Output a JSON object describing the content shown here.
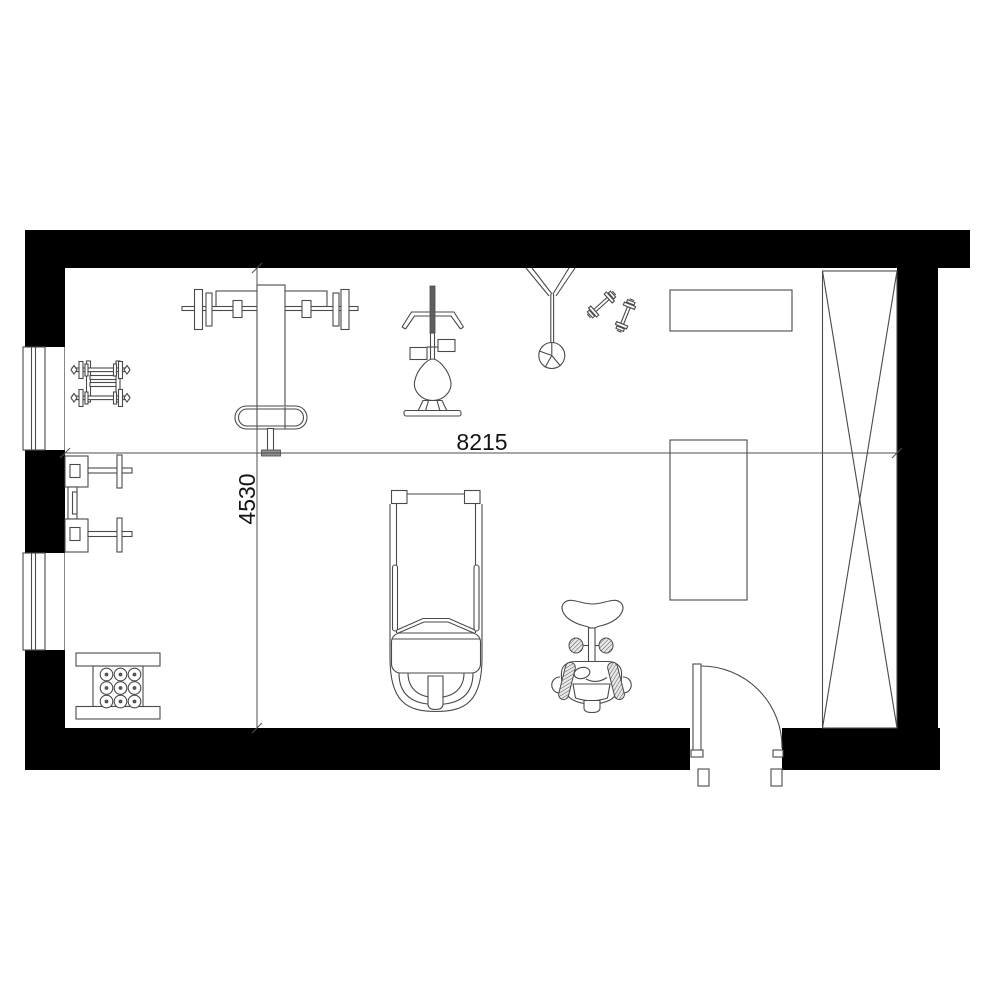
{
  "drawing": {
    "type": "floor-plan",
    "room": "home-gym"
  },
  "dimensions": {
    "width_mm": "8215",
    "height_mm": "4530"
  },
  "colors": {
    "background": "#ffffff",
    "wall_fill": "#000000",
    "line": "#4a4a4a",
    "dimension_line": "#4f4f4f",
    "dimension_text": "#141414",
    "equipment_fill": "#ffffff",
    "dark_fill": "#5f5f5f",
    "grey_fill": "#8f8f8f"
  },
  "equipment": [
    {
      "id": "dumbbell-rack-icon"
    },
    {
      "id": "wall-mounted-unit-icon"
    },
    {
      "id": "bench-press-icon"
    },
    {
      "id": "lat-pulldown-icon"
    },
    {
      "id": "punching-bag-icon"
    },
    {
      "id": "hand-dumbbells-icon"
    },
    {
      "id": "exercise-mat-icon"
    },
    {
      "id": "weight-bench-icon"
    },
    {
      "id": "weight-storage-rack-icon"
    },
    {
      "id": "treadmill-icon"
    },
    {
      "id": "exercise-bike-icon"
    },
    {
      "id": "wardrobe-icon"
    },
    {
      "id": "window-icon"
    },
    {
      "id": "door-icon"
    }
  ]
}
